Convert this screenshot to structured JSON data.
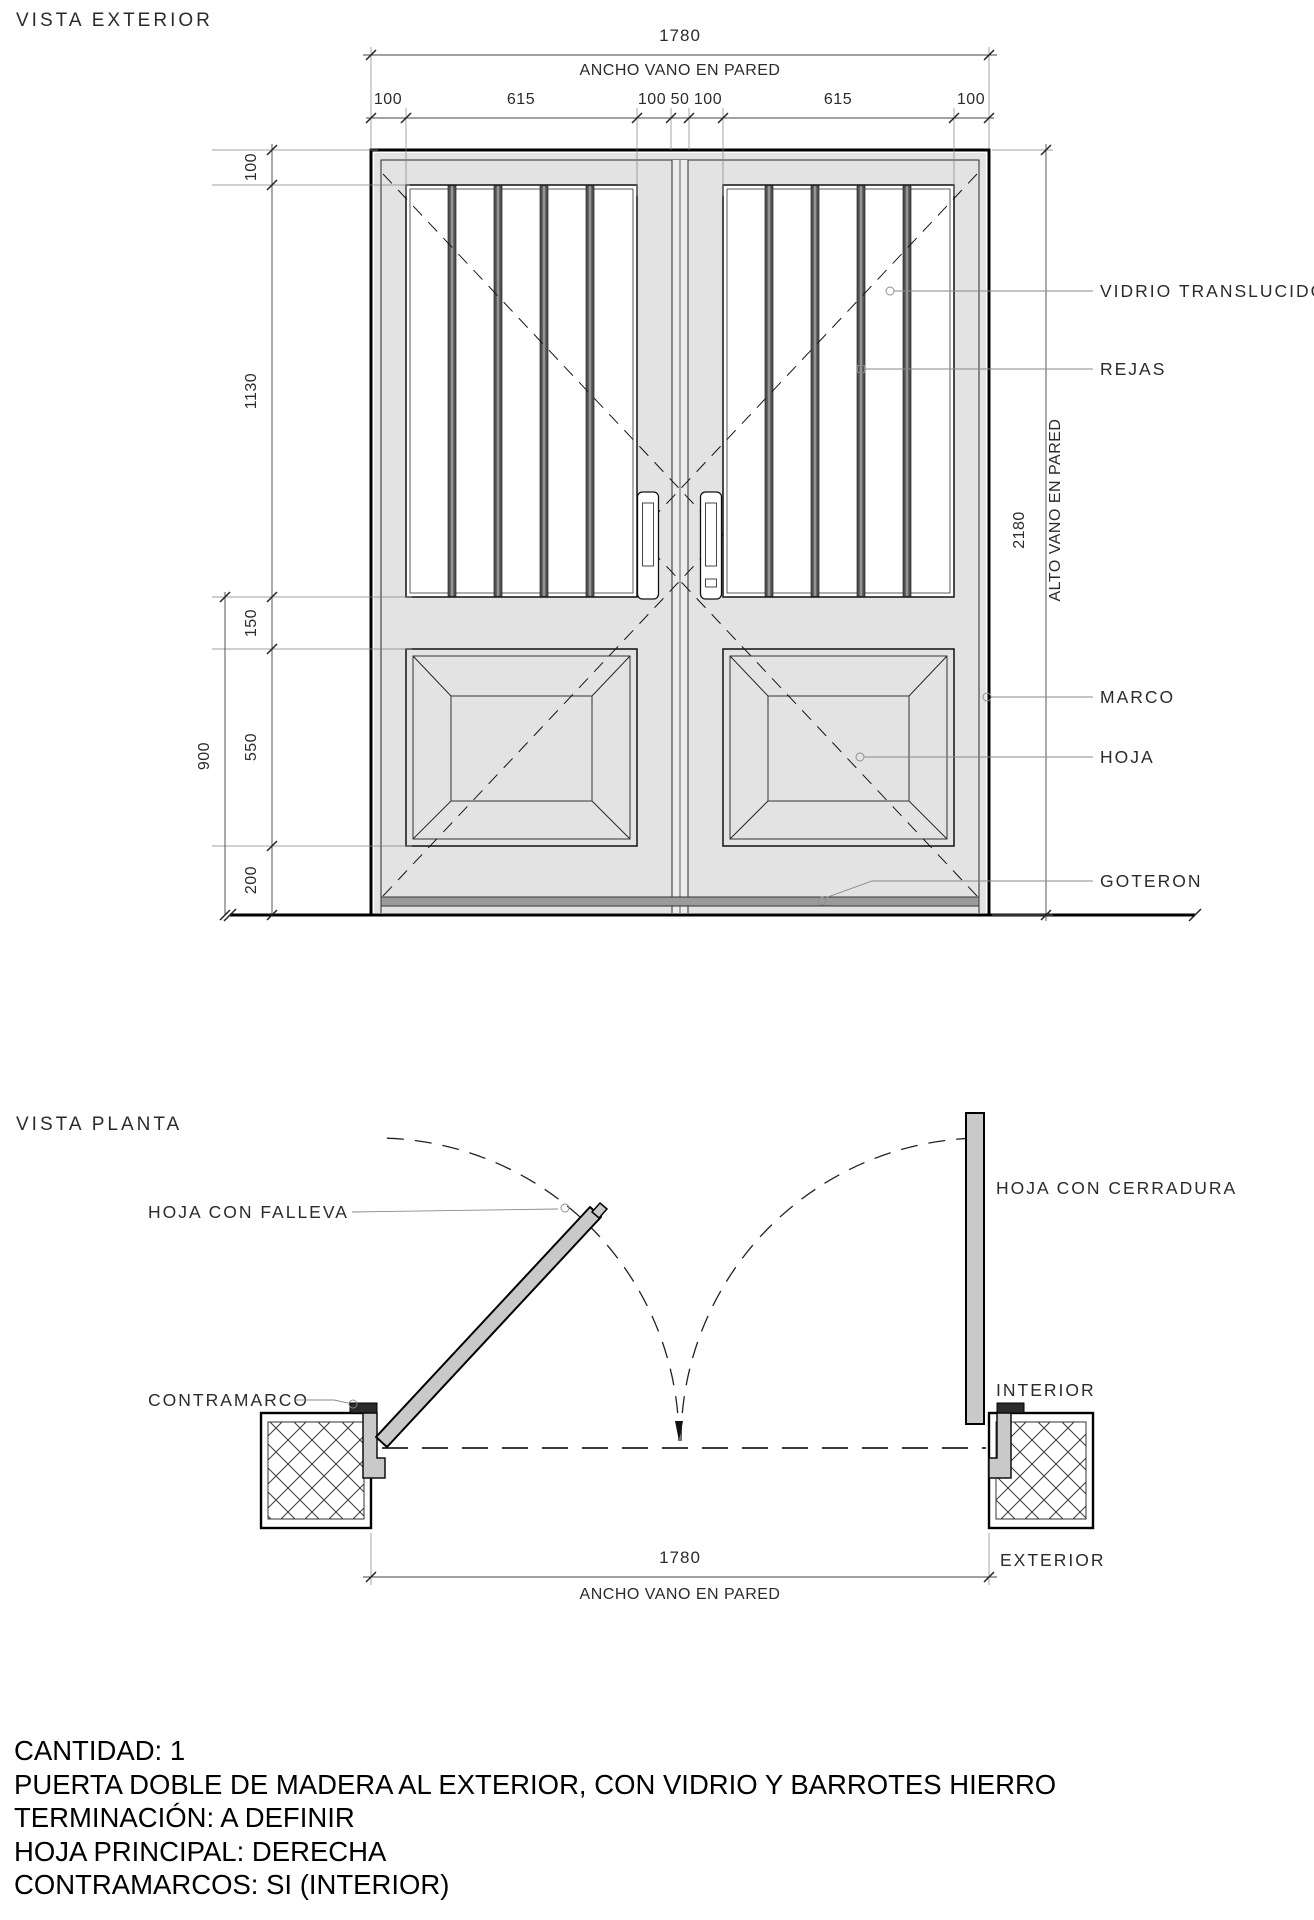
{
  "titles": {
    "elevation": "VISTA EXTERIOR",
    "plan": "VISTA PLANTA"
  },
  "elevation": {
    "dims": {
      "width_total": "1780",
      "width_label": "ANCHO VANO EN PARED",
      "width_segments": [
        "100",
        "615",
        "100",
        "50",
        "100",
        "615",
        "100"
      ],
      "left_segments": [
        "100",
        "1130",
        "150",
        "550",
        "200"
      ],
      "left_total": "900",
      "height_total": "2180",
      "height_label": "ALTO VANO EN PARED"
    },
    "callouts": {
      "glass": "VIDRIO TRANSLUCIDO",
      "bars": "REJAS",
      "frame": "MARCO",
      "leaf": "HOJA",
      "drip": "GOTERON"
    }
  },
  "plan": {
    "labels": {
      "left_leaf": "HOJA CON FALLEVA",
      "subframe": "CONTRAMARCO",
      "right_leaf": "HOJA CON CERRADURA",
      "interior": "INTERIOR",
      "exterior": "EXTERIOR"
    },
    "dims": {
      "width_total": "1780",
      "width_label": "ANCHO VANO EN PARED"
    }
  },
  "notes": [
    "CANTIDAD: 1",
    "PUERTA DOBLE DE MADERA AL EXTERIOR, CON VIDRIO Y BARROTES HIERRO",
    "TERMINACIÓN: A DEFINIR",
    "HOJA PRINCIPAL: DERECHA",
    "CONTRAMARCOS: SI (INTERIOR)"
  ],
  "colors": {
    "leaf_fill": "#e3e3e3",
    "stile_fill": "#ececec",
    "plan_leaf_fill": "#c9c9c9",
    "bar_dark": "#515151",
    "bar_light": "#949494",
    "drip_fill": "#9b9b9b",
    "contramarco_fill": "#2b2b2b",
    "line": "#111111",
    "leader": "#8a8a8a"
  }
}
